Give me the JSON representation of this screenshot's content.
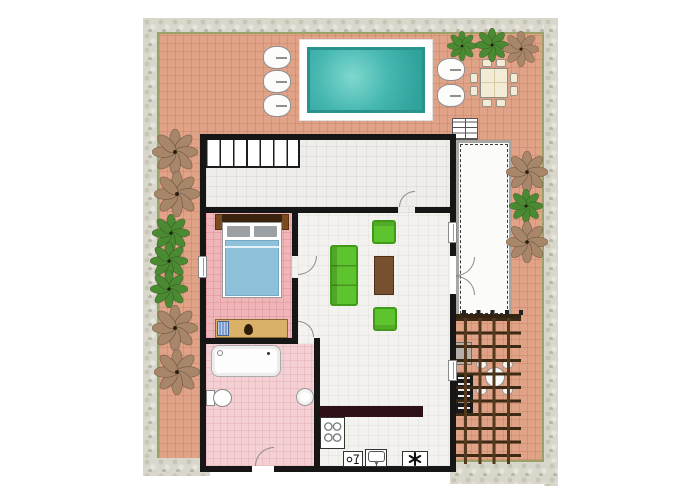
{
  "page": {
    "type": "residential-floor-plan-screenshot",
    "visible_text": []
  },
  "colors": {
    "wall": "#161616",
    "patio": "#e1a387",
    "stone": "#d9d7cb",
    "stone_edge": "#9ba268",
    "hall_floor": "#eeede9",
    "living_floor": "#f3f2ee",
    "bedroom_floor": "#f0b5b9",
    "bathroom_floor": "#f4d0d4",
    "pool_water": "#45b7b0",
    "pool_water_light": "#7fd8cf",
    "pool_edge": "#2a928c",
    "sofa": "#5ec42e",
    "sofa_dark": "#3f9a17",
    "coffee_table": "#77512f",
    "counter": "#2d0f16",
    "desk": "#d9b169",
    "blanket": "#8cc1d9",
    "pillow": "#9aa0a4",
    "headboard": "#3a240d",
    "nightstand": "#7c4b20",
    "pergola_beam": "#55391f",
    "pergola_beam_dark": "#3c2a15",
    "tree_green": "#4a8a33",
    "tree_brown": "#a8866a",
    "deck_border": "#a8a8a2",
    "cream": "#f2ecd7",
    "bbq_black": "#191919",
    "bbq_gray": "#b4b0a9",
    "basket_blue": "#7f9fd0"
  },
  "plan": {
    "rooms": [
      {
        "name": "hallway",
        "floor": "light-gray-tile",
        "features": [
          "interior-staircase"
        ]
      },
      {
        "name": "bedroom",
        "floor": "pink-tile",
        "furniture": [
          "double-bed",
          "two-nightstands",
          "two-pillows",
          "desk",
          "desk-chair",
          "blue-basket"
        ]
      },
      {
        "name": "bathroom",
        "floor": "light-pink-tile",
        "furniture": [
          "bathtub",
          "toilet",
          "round-washbasin"
        ]
      },
      {
        "name": "living-room",
        "floor": "white-tile",
        "furniture": [
          "green-sofa",
          "coffee-table",
          "green-armchair-top",
          "green-armchair-bottom"
        ]
      },
      {
        "name": "kitchen",
        "floor": "white-tile",
        "furniture": [
          "dark-counter",
          "stove-four-burners",
          "dishwasher",
          "kitchen-sink",
          "freezer"
        ]
      },
      {
        "name": "veranda-deck",
        "floor": "white-deck",
        "features": [
          "double-door-from-living-room",
          "exterior-steps"
        ]
      }
    ],
    "outdoor": {
      "swimming_pool": 1,
      "sun_loungers": 5,
      "patio_dining_set": {
        "table": 1,
        "chairs": 8
      },
      "pergola": {
        "bbq_grill": 1,
        "bistro_table": 1,
        "chairs": 4
      },
      "trees_green": 6,
      "trees_brown": 7,
      "stone_border": true,
      "terracotta_patio": true
    },
    "doors": [
      "hallway-to-living",
      "bedroom-to-living",
      "living-to-bathroom",
      "bathroom-to-outside",
      "living-to-veranda-double-door"
    ],
    "windows": [
      "bedroom-left-wall",
      "living-room-right-wall",
      "kitchen-right-wall"
    ]
  }
}
